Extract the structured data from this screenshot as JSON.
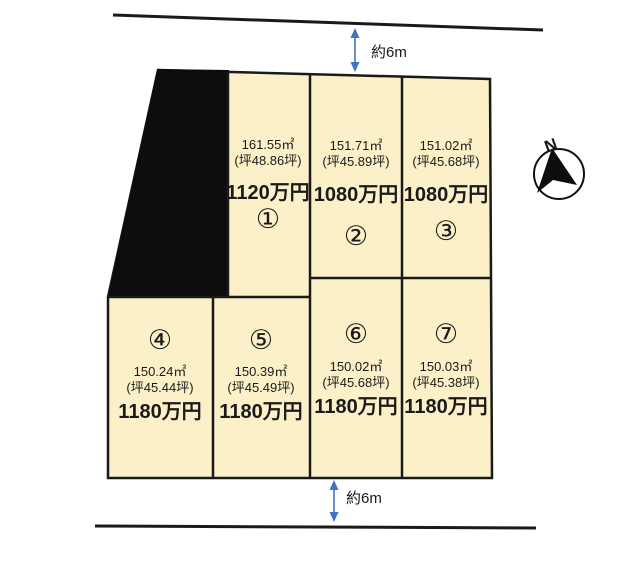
{
  "roads": {
    "top": {
      "width_label": "約6m"
    },
    "bottom": {
      "width_label": "約6m"
    }
  },
  "compass": {
    "north_label": "N"
  },
  "colors": {
    "plot_fill": "#FBF0C8",
    "outline": "#1A1A1A",
    "black_area": "#0D0D0D",
    "arrow": "#4472C4"
  },
  "plots": [
    {
      "number": "①",
      "area_sqm": "161.55㎡",
      "area_tsubo": "(坪48.86坪)",
      "price": "1120万円"
    },
    {
      "number": "②",
      "area_sqm": "151.71㎡",
      "area_tsubo": "(坪45.89坪)",
      "price": "1080万円"
    },
    {
      "number": "③",
      "area_sqm": "151.02㎡",
      "area_tsubo": "(坪45.68坪)",
      "price": "1080万円"
    },
    {
      "number": "④",
      "area_sqm": "150.24㎡",
      "area_tsubo": "(坪45.44坪)",
      "price": "1180万円"
    },
    {
      "number": "⑤",
      "area_sqm": "150.39㎡",
      "area_tsubo": "(坪45.49坪)",
      "price": "1180万円"
    },
    {
      "number": "⑥",
      "area_sqm": "150.02㎡",
      "area_tsubo": "(坪45.68坪)",
      "price": "1180万円"
    },
    {
      "number": "⑦",
      "area_sqm": "150.03㎡",
      "area_tsubo": "(坪45.38坪)",
      "price": "1180万円"
    }
  ]
}
